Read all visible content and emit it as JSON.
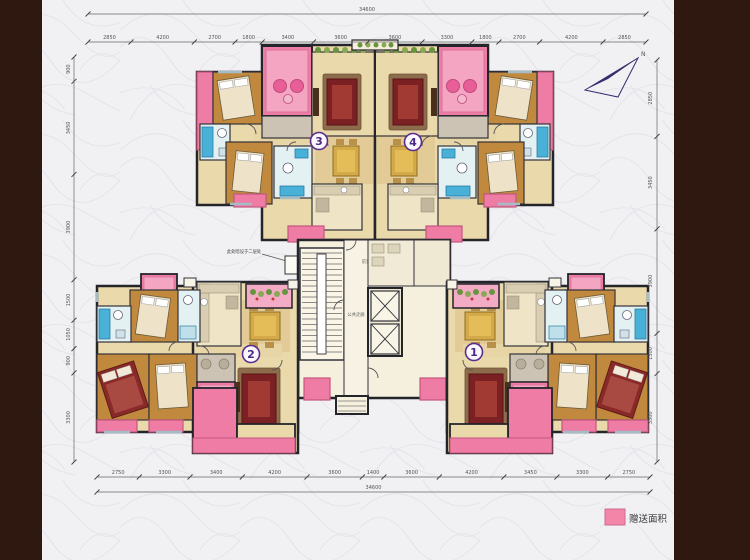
{
  "compass": {
    "label": "N"
  },
  "legend": {
    "label": "赠送面积",
    "swatch_color": "#f285a8"
  },
  "annotation": {
    "text": "此处暗设于二层处"
  },
  "core_labels": {
    "vestibule": "前室",
    "corridor": "公共走廊"
  },
  "unit_labels": {
    "u1": "1",
    "u2": "2",
    "u3": "3",
    "u4": "4"
  },
  "dimensions": {
    "top": {
      "total": "34600",
      "segments": [
        "2850",
        "4200",
        "2700",
        "1800",
        "3400",
        "3600",
        "3600",
        "3300",
        "1800",
        "2700",
        "4200",
        "2850"
      ]
    },
    "bottom": {
      "total": "34600",
      "segments": [
        "2750",
        "3300",
        "3400",
        "4200",
        "3600",
        "1400",
        "3600",
        "4200",
        "3450",
        "3300",
        "2750"
      ]
    },
    "left": {
      "segments": [
        "900",
        "3450",
        "3900",
        "1500",
        "1050",
        "900",
        "3300"
      ]
    },
    "right": {
      "segments": [
        "2850",
        "3450",
        "3900",
        "1500",
        "3300"
      ]
    }
  },
  "palette": {
    "balcony_pink": "#ee7ca4",
    "balcony_pink_light": "#f3a5c2",
    "floor_tan": "#ead9ab",
    "wood_floor": "#c1893e",
    "sofa_red": "#7b2023",
    "bath_blue": "#49b0d8",
    "wall": "#24242b",
    "frame_brown": "#2e180f",
    "unit_badge_purple": "#4b2a86",
    "north_arrow_purple": "#3b2c70"
  }
}
